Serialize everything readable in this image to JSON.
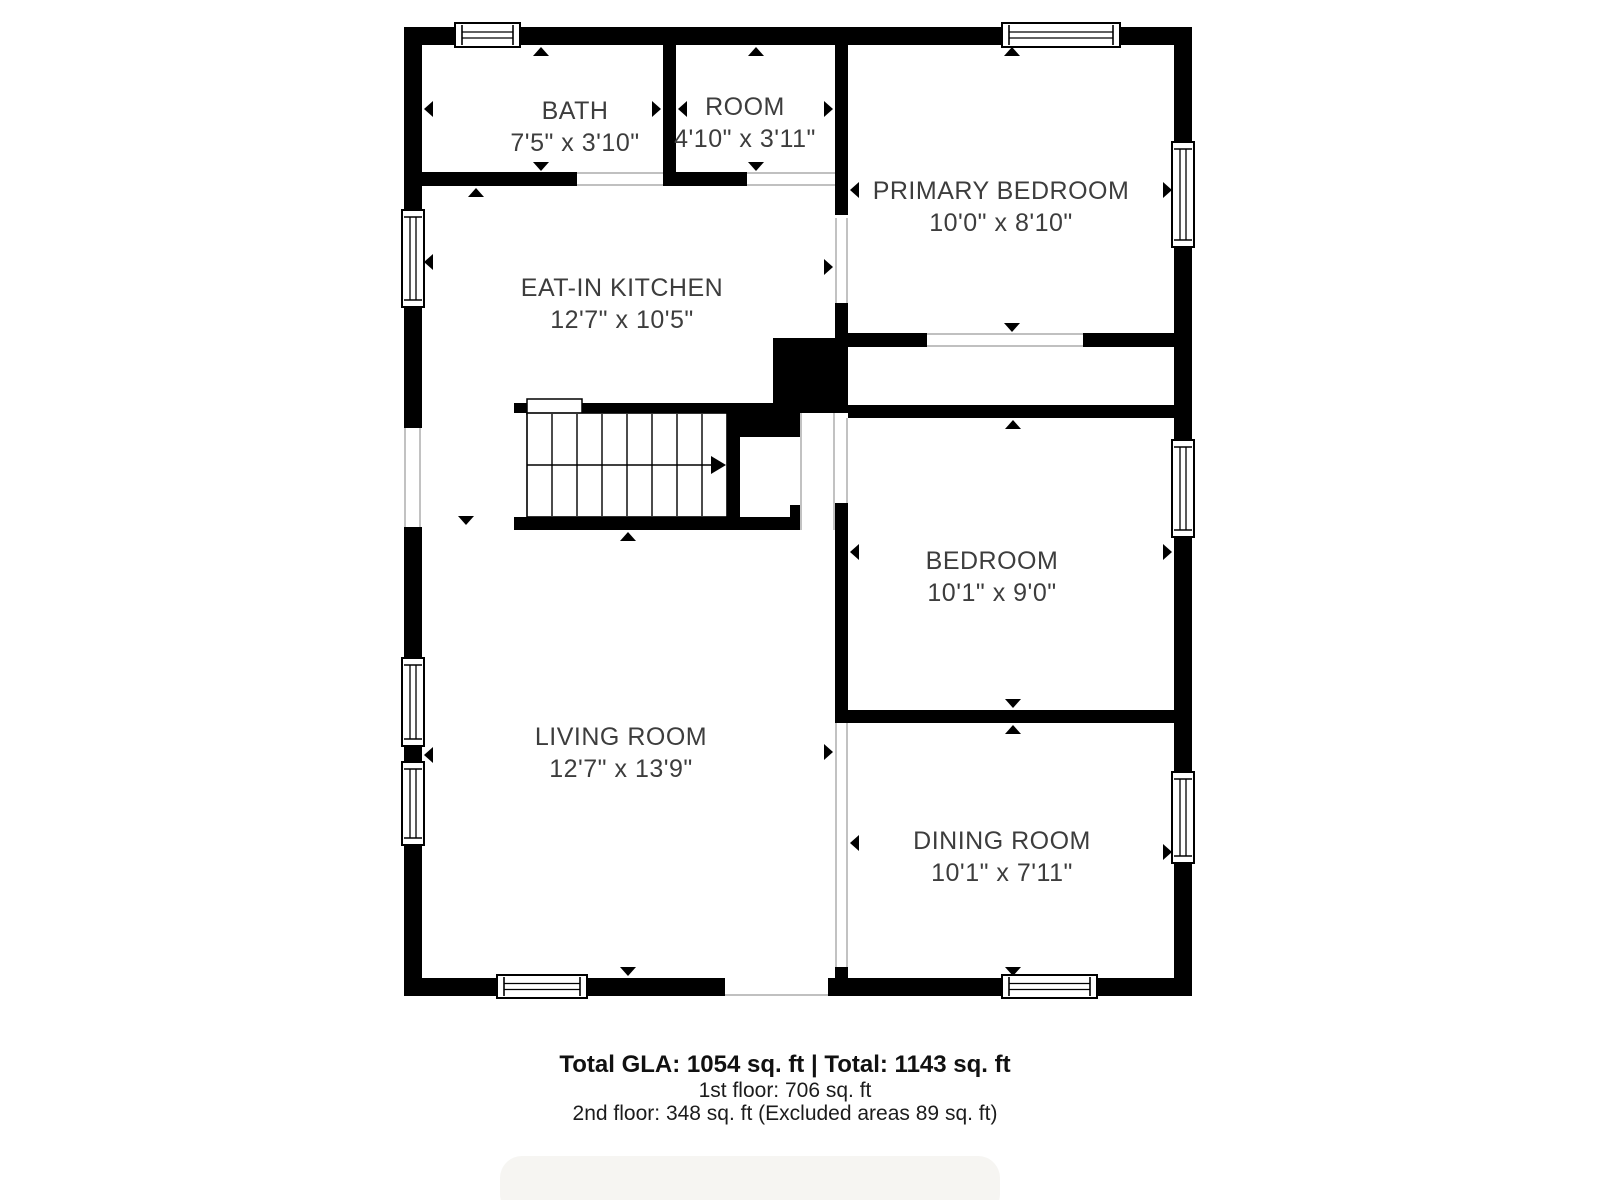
{
  "rooms": [
    {
      "name": "BATH",
      "dims": "7'5\" x 3'10\"",
      "cx": 575,
      "cy": 119
    },
    {
      "name": "ROOM",
      "dims": "4'10\" x 3'11\"",
      "cx": 745,
      "cy": 115
    },
    {
      "name": "PRIMARY BEDROOM",
      "dims": "10'0\" x 8'10\"",
      "cx": 1001,
      "cy": 199
    },
    {
      "name": "EAT-IN KITCHEN",
      "dims": "12'7\" x 10'5\"",
      "cx": 622,
      "cy": 296
    },
    {
      "name": "BEDROOM",
      "dims": "10'1\" x 9'0\"",
      "cx": 992,
      "cy": 569
    },
    {
      "name": "LIVING ROOM",
      "dims": "12'7\" x 13'9\"",
      "cx": 621,
      "cy": 745
    },
    {
      "name": "DINING ROOM",
      "dims": "10'1\" x 7'11\"",
      "cx": 1002,
      "cy": 849
    }
  ],
  "footer": {
    "line1": "Total GLA: 1054 sq. ft | Total: 1143 sq. ft",
    "line2": "1st floor: 706 sq. ft",
    "line3": "2nd floor: 348 sq. ft (Excluded areas 89 sq. ft)"
  },
  "colors": {
    "wall": "#000000",
    "label": "#3d3d3d",
    "opening_line": "#9a9a9a",
    "window_stroke": "#000000",
    "bottom_bar": "#f6f5f2"
  },
  "plan": {
    "walls": [
      [
        404,
        27,
        788,
        18
      ],
      [
        404,
        978,
        788,
        18
      ],
      [
        404,
        27,
        18,
        969
      ],
      [
        1174,
        27,
        18,
        969
      ],
      [
        663,
        45,
        13,
        127
      ],
      [
        422,
        172,
        155,
        14
      ],
      [
        663,
        172,
        84,
        14
      ],
      [
        835,
        45,
        13,
        170
      ],
      [
        835,
        303,
        13,
        45
      ],
      [
        773,
        338,
        75,
        75
      ],
      [
        848,
        333,
        79,
        14
      ],
      [
        1083,
        333,
        91,
        14
      ],
      [
        848,
        405,
        326,
        13
      ],
      [
        514,
        403,
        259,
        10
      ],
      [
        727,
        403,
        13,
        127
      ],
      [
        740,
        413,
        62,
        24
      ],
      [
        790,
        505,
        12,
        12
      ],
      [
        514,
        517,
        286,
        13
      ],
      [
        835,
        503,
        13,
        220
      ],
      [
        835,
        710,
        339,
        13
      ],
      [
        835,
        967,
        13,
        11
      ],
      [
        404,
        746,
        18,
        16
      ]
    ],
    "white_rects": [
      [
        402,
        428,
        22,
        99
      ],
      [
        725,
        978,
        103,
        18
      ],
      [
        835,
        723,
        13,
        244
      ],
      [
        800,
        413,
        35,
        117
      ]
    ],
    "gray_lines": [
      [
        405,
        428,
        405,
        527
      ],
      [
        420,
        428,
        420,
        527
      ],
      [
        836,
        723,
        836,
        967
      ],
      [
        847,
        723,
        847,
        967
      ],
      [
        801,
        413,
        801,
        530
      ],
      [
        834,
        413,
        834,
        530
      ],
      [
        836,
        218,
        836,
        303
      ],
      [
        847,
        218,
        847,
        303
      ],
      [
        847,
        418,
        847,
        503
      ],
      [
        577,
        173,
        663,
        173
      ],
      [
        577,
        185,
        663,
        185
      ],
      [
        747,
        173,
        835,
        173
      ],
      [
        747,
        185,
        835,
        185
      ],
      [
        927,
        334,
        1083,
        334
      ],
      [
        927,
        346,
        1083,
        346
      ],
      [
        725,
        995,
        828,
        995
      ]
    ],
    "landing": [
      527,
      399,
      55,
      15
    ],
    "windows": [
      {
        "o": "h",
        "x": 455,
        "y": 23,
        "w": 65,
        "h": 24
      },
      {
        "o": "h",
        "x": 1002,
        "y": 23,
        "w": 118,
        "h": 24
      },
      {
        "o": "h",
        "x": 497,
        "y": 975,
        "w": 90,
        "h": 23
      },
      {
        "o": "h",
        "x": 1002,
        "y": 975,
        "w": 95,
        "h": 23
      },
      {
        "o": "v",
        "x": 402,
        "y": 210,
        "w": 22,
        "h": 97
      },
      {
        "o": "v",
        "x": 402,
        "y": 658,
        "w": 22,
        "h": 88
      },
      {
        "o": "v",
        "x": 402,
        "y": 762,
        "w": 22,
        "h": 83
      },
      {
        "o": "v",
        "x": 1172,
        "y": 142,
        "w": 22,
        "h": 105
      },
      {
        "o": "v",
        "x": 1172,
        "y": 440,
        "w": 22,
        "h": 97
      },
      {
        "o": "v",
        "x": 1172,
        "y": 772,
        "w": 22,
        "h": 91
      }
    ],
    "stairs": {
      "x": 527,
      "y": 413,
      "w": 200,
      "h": 104,
      "treads": [
        552,
        577,
        602,
        627,
        652,
        677,
        702
      ],
      "arrow_y": 465,
      "arrow_tip": 726
    },
    "markers": [
      {
        "d": "up",
        "x": 541,
        "y": 47
      },
      {
        "d": "down",
        "x": 541,
        "y": 171
      },
      {
        "d": "left",
        "x": 424,
        "y": 109
      },
      {
        "d": "right",
        "x": 661,
        "y": 109
      },
      {
        "d": "up",
        "x": 756,
        "y": 47
      },
      {
        "d": "down",
        "x": 756,
        "y": 171
      },
      {
        "d": "left",
        "x": 678,
        "y": 109
      },
      {
        "d": "right",
        "x": 833,
        "y": 109
      },
      {
        "d": "up",
        "x": 1012,
        "y": 47
      },
      {
        "d": "right",
        "x": 1172,
        "y": 190
      },
      {
        "d": "down",
        "x": 1012,
        "y": 332
      },
      {
        "d": "left",
        "x": 850,
        "y": 190
      },
      {
        "d": "up",
        "x": 476,
        "y": 188
      },
      {
        "d": "left",
        "x": 424,
        "y": 262
      },
      {
        "d": "right",
        "x": 833,
        "y": 267
      },
      {
        "d": "down",
        "x": 466,
        "y": 525
      },
      {
        "d": "up",
        "x": 628,
        "y": 532
      },
      {
        "d": "left",
        "x": 424,
        "y": 755
      },
      {
        "d": "right",
        "x": 833,
        "y": 752
      },
      {
        "d": "down",
        "x": 628,
        "y": 976
      },
      {
        "d": "up",
        "x": 1013,
        "y": 420
      },
      {
        "d": "left",
        "x": 850,
        "y": 552
      },
      {
        "d": "right",
        "x": 1172,
        "y": 552
      },
      {
        "d": "down",
        "x": 1013,
        "y": 708
      },
      {
        "d": "up",
        "x": 1013,
        "y": 725
      },
      {
        "d": "left",
        "x": 850,
        "y": 843
      },
      {
        "d": "right",
        "x": 1172,
        "y": 852
      },
      {
        "d": "down",
        "x": 1013,
        "y": 976
      }
    ],
    "bottom_bar": [
      500,
      1156,
      500,
      60
    ]
  }
}
